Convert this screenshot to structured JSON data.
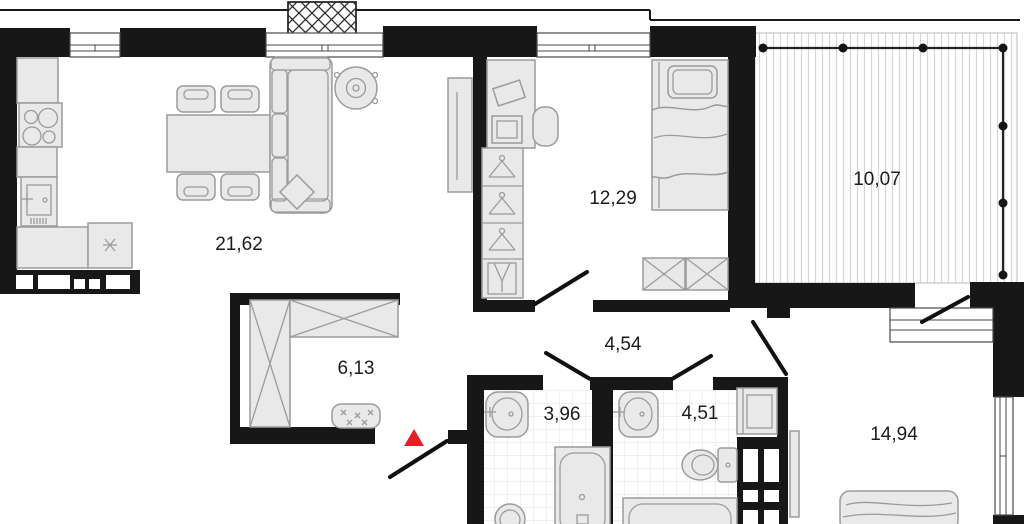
{
  "plan": {
    "rooms": [
      {
        "name": "kitchen-living-room",
        "area": "21,62"
      },
      {
        "name": "bedroom",
        "area": "12,29"
      },
      {
        "name": "balcony",
        "area": "10,07"
      },
      {
        "name": "entry-hall",
        "area": "6,13"
      },
      {
        "name": "corridor",
        "area": "4,54"
      },
      {
        "name": "bathroom",
        "area": "3,96"
      },
      {
        "name": "bathroom-2",
        "area": "4,51"
      },
      {
        "name": "bedroom-2",
        "area": "14,94"
      }
    ],
    "entrance_marker": "red-triangle",
    "colors": {
      "background": "#ffffff",
      "wall": "#171717",
      "furniture_fill": "#e9e9e9",
      "furniture_stroke": "#9b9b9b",
      "tile_line": "#e2e2e2",
      "hatch_line": "#d6d6d6",
      "marker_red": "#e31e24",
      "label_text": "#1c1c1c"
    }
  }
}
